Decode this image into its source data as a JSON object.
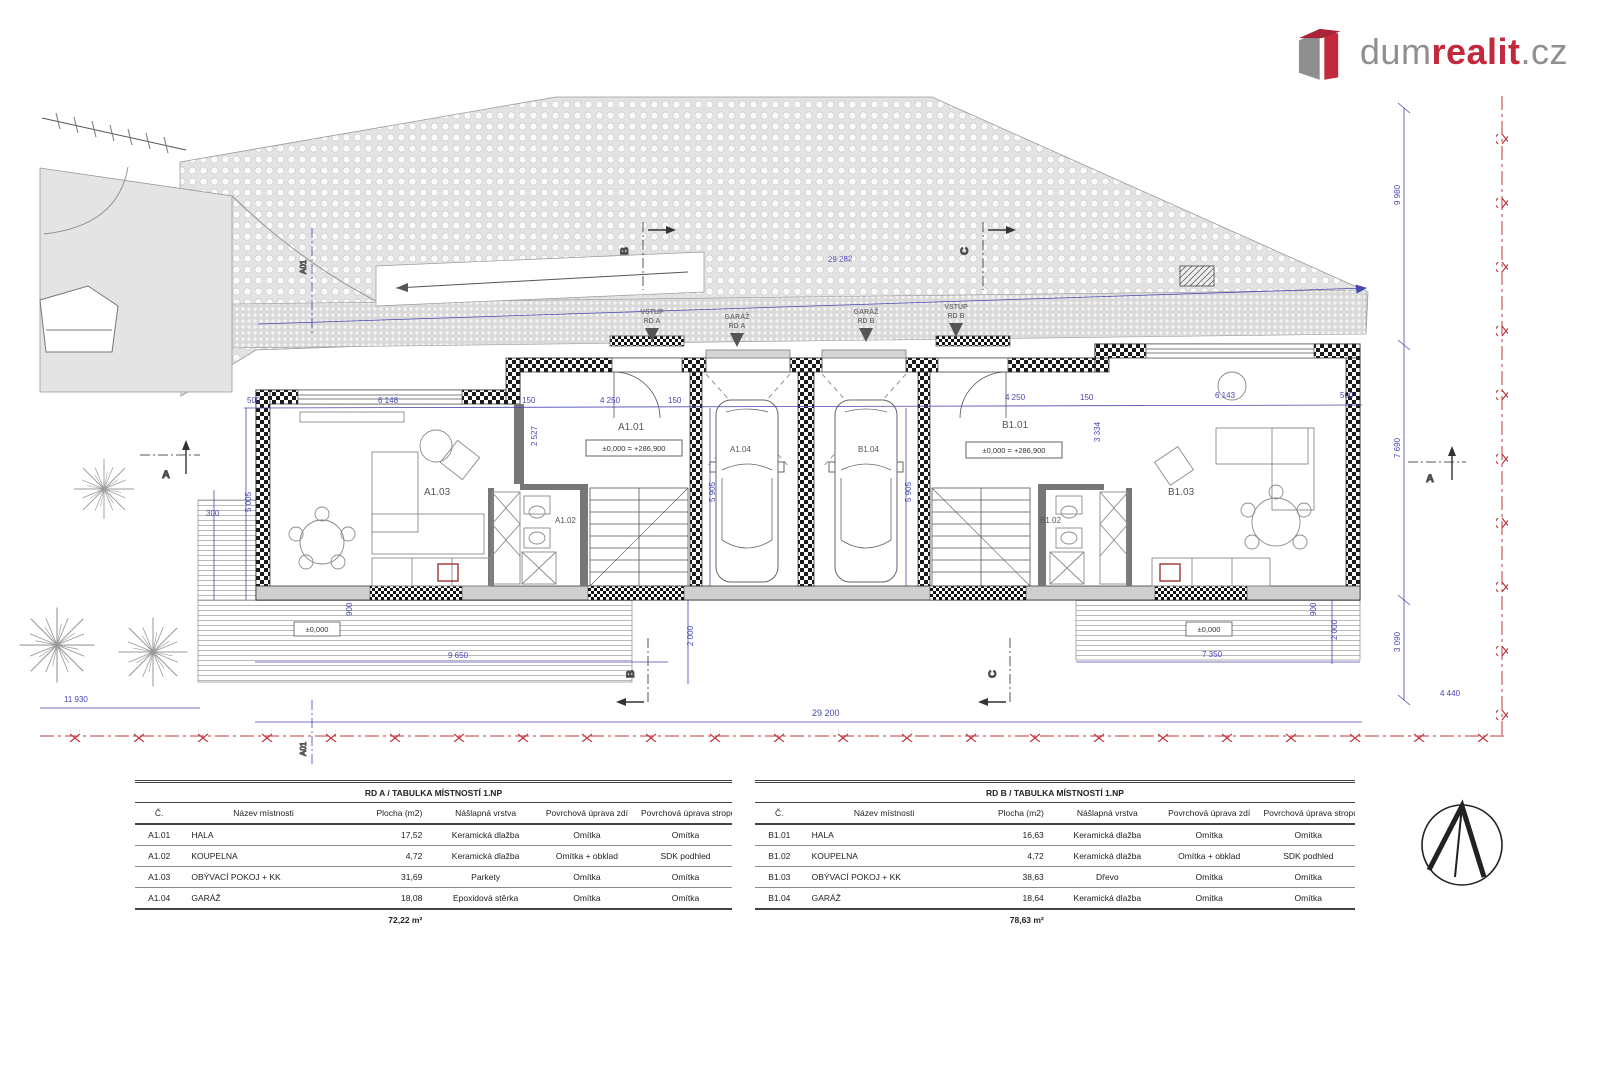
{
  "logo": {
    "word1": "dum",
    "word2": "realit",
    "word3": ".cz"
  },
  "plan": {
    "rooms": {
      "a101": "A1.01",
      "a102": "A1.02",
      "a103": "A1.03",
      "a104": "A1.04",
      "b101": "B1.01",
      "b102": "B1.02",
      "b103": "B1.03",
      "b104": "B1.04"
    },
    "elevations": {
      "main": "±0,000 = +286,900",
      "zero": "±0,000"
    },
    "entrances": {
      "vstup_a": [
        "VSTUP",
        "RD A"
      ],
      "garaz_a": [
        "GARÁŽ",
        "RD A"
      ],
      "garaz_b": [
        "GARÁŽ",
        "RD B"
      ],
      "vstup_b": [
        "VSTUP",
        "RD B"
      ]
    },
    "sections": {
      "a": "A",
      "b": "B",
      "c": "C",
      "a01": "A01"
    },
    "dims": {
      "d500": "500",
      "d6148": "6 148",
      "d150": "150",
      "d4250": "4 250",
      "d2527": "2 527",
      "d3334": "3 334",
      "d5005": "5 005",
      "d5905": "5 905",
      "d300": "300",
      "d900": "900",
      "d9650": "9 650",
      "d2000": "2 000",
      "d11930": "11 930",
      "d29200": "29 200",
      "d29282": "29 282",
      "d7350": "7 350",
      "d6143": "6 143",
      "d9980": "9 980",
      "d7690": "7 690",
      "d3090": "3 090",
      "d4440": "4 440"
    }
  },
  "tables": {
    "headers": [
      "Č.",
      "Název místnosti",
      "Plocha (m2)",
      "Nášlapná vrstva",
      "Povrchová úprava zdí",
      "Povrchová úprava stropu"
    ],
    "a": {
      "title": "RD A / TABULKA MÍSTNOSTÍ 1.NP",
      "rows": [
        [
          "A1.01",
          "HALA",
          "17,52",
          "Keramická dlažba",
          "Omítka",
          "Omítka"
        ],
        [
          "A1.02",
          "KOUPELNA",
          "4,72",
          "Keramická dlažba",
          "Omítka + obklad",
          "SDK podhled"
        ],
        [
          "A1.03",
          "OBÝVACÍ POKOJ + KK",
          "31,69",
          "Parkety",
          "Omítka",
          "Omítka"
        ],
        [
          "A1.04",
          "GARÁŽ",
          "18,08",
          "Epoxidová stěrka",
          "Omítka",
          "Omítka"
        ]
      ],
      "total": "72,22 m²"
    },
    "b": {
      "title": "RD B / TABULKA MÍSTNOSTÍ 1.NP",
      "rows": [
        [
          "B1.01",
          "HALA",
          "16,63",
          "Keramická dlažba",
          "Omítka",
          "Omítka"
        ],
        [
          "B1.02",
          "KOUPELNA",
          "4,72",
          "Keramická dlažba",
          "Omítka + obklad",
          "SDK podhled"
        ],
        [
          "B1.03",
          "OBÝVACÍ POKOJ + KK",
          "38,63",
          "Dřevo",
          "Omítka",
          "Omítka"
        ],
        [
          "B1.04",
          "GARÁŽ",
          "18,64",
          "Keramická dlažba",
          "Omítka",
          "Omítka"
        ]
      ],
      "total": "78,63 m²"
    }
  }
}
